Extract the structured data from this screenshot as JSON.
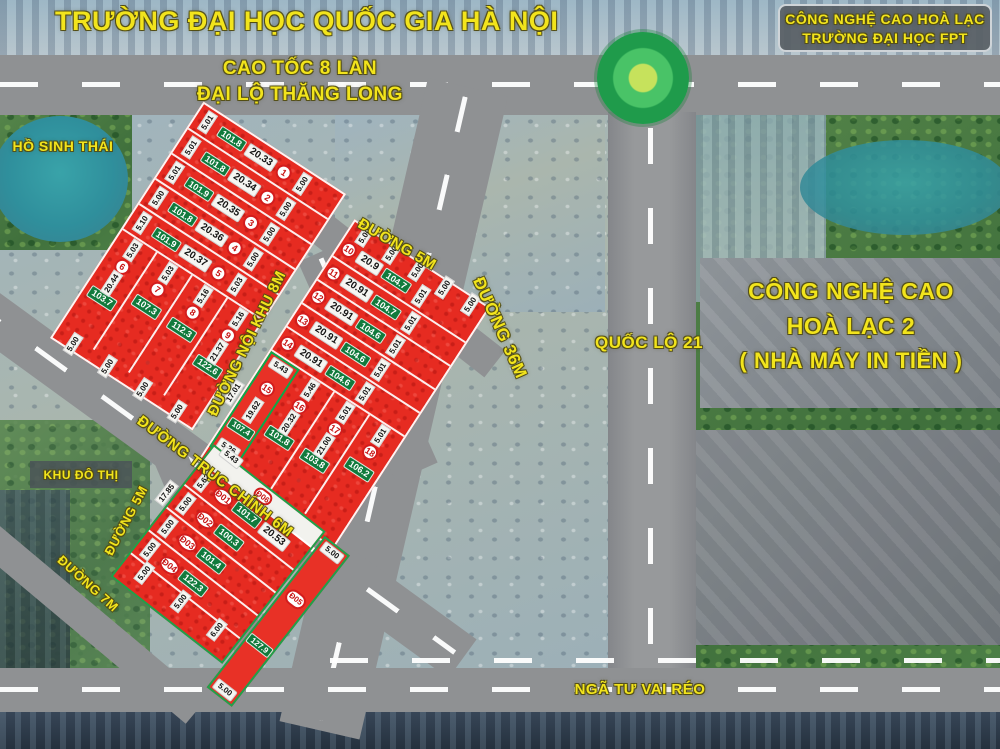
{
  "title": {
    "top": "TRƯỜNG ĐẠI HỌC QUỐC GIA HÀ NỘI"
  },
  "roads": {
    "expressway_1": "CAO TỐC 8 LÀN",
    "expressway_2": "ĐẠI LỘ THĂNG LONG",
    "noi_khu": "ĐƯỜNG NỘI KHU 8M",
    "d5_upper": "ĐƯỜNG 5M",
    "d36": "ĐƯỜNG 36M",
    "ql21": "QUỐC LỘ 21",
    "truc_chinh": "ĐƯỜNG TRỤC CHÍNH 6M",
    "d5_lower": "ĐƯỜNG 5M",
    "d7": "ĐƯỜNG 7M",
    "intersection": "NGÃ TƯ VAI RÉO"
  },
  "areas": {
    "lake": "HỒ SINH THÁI",
    "urban": "KHU ĐÔ THỊ",
    "fpt_1": "CÔNG NGHỆ CAO HOÀ LẠC",
    "fpt_2": "TRƯỜNG ĐẠI HỌC FPT",
    "hitech_1": "CÔNG NGHỆ CAO",
    "hitech_2": "HOÀ LẠC 2",
    "hitech_3": "( NHÀ MÁY IN TIỀN )"
  },
  "colors": {
    "plot_red": "#e62b21",
    "area_green": "#117a3c",
    "label_yellow": "#f2e41c",
    "road_gray": "#8f9193",
    "highlight_green": "#0ca94a",
    "lake_teal": "#2f9aa0"
  },
  "blocks": {
    "block_a": {
      "rows": [
        {
          "no": "1",
          "area": "101.8",
          "width": "20.33",
          "left": "5.01",
          "right": "5.00"
        },
        {
          "no": "2",
          "area": "101.8",
          "width": "20.34",
          "left": "5.01",
          "right": "5.00"
        },
        {
          "no": "3",
          "area": "101.9",
          "width": "20.35",
          "left": "5.01",
          "right": "5.00"
        },
        {
          "no": "4",
          "area": "101.8",
          "width": "20.36",
          "left": "5.00",
          "right": "5.00"
        },
        {
          "no": "5",
          "area": "101.9",
          "width": "20.37",
          "left": "5.10",
          "right": "5.03"
        }
      ],
      "columns": [
        {
          "no": "6",
          "area": "103.7",
          "top": "5.03",
          "depth": "20.44"
        },
        {
          "no": "7",
          "area": "107.3",
          "top": "5.03"
        },
        {
          "no": "8",
          "area": "112.3",
          "top": "5.16"
        },
        {
          "no": "9",
          "area": "122.6",
          "top": "5.16",
          "depth": "21.37"
        }
      ],
      "bottom_edge": [
        "5.00",
        "5.00",
        "5.00",
        "5.00"
      ]
    },
    "block_b": {
      "top_edge": [
        "5.00",
        "5.00",
        "5.00",
        "5.00",
        "5.00"
      ],
      "rows": [
        {
          "no": "10",
          "width": "20.9",
          "area": "104.7",
          "right": "5.01"
        },
        {
          "no": "11",
          "width": "20.91",
          "area": "104.7",
          "right": "5.01"
        },
        {
          "no": "12",
          "width": "20.91",
          "area": "104.6",
          "right": "5.01"
        },
        {
          "no": "13",
          "width": "20.91",
          "area": "104.6",
          "right": "5.01"
        },
        {
          "no": "14",
          "width": "20.91",
          "area": "104.6",
          "right": "5.01"
        }
      ],
      "highlight": {
        "no": "15",
        "area": "107.4",
        "top": "5.43",
        "left": "17.01",
        "right": "19.62",
        "bottom": "5.26"
      },
      "columns": [
        {
          "no": "16",
          "area": "101.8",
          "top": "5.46",
          "depth": "20.32"
        },
        {
          "no": "17",
          "area": "103.8",
          "top": "5.01",
          "depth": "21.00"
        },
        {
          "no": "18",
          "area": "106.2",
          "top": "5.01"
        }
      ]
    },
    "block_c": {
      "road_strip_no": "Đ06",
      "top_edge": "5.43",
      "left_edge": "17.85",
      "rows": [
        {
          "no": "Đ01",
          "area": "101.7",
          "width": "20.53",
          "left": "5.62"
        },
        {
          "no": "Đ02",
          "area": "100.3",
          "left": "5.00"
        },
        {
          "no": "Đ03",
          "area": "101.4",
          "left": "5.00"
        },
        {
          "no": "Đ04",
          "area": "122.3",
          "left": "5.00"
        }
      ],
      "strip": {
        "no": "Đ05",
        "area": "127.9",
        "top": "5.00",
        "bottom": "5.00"
      },
      "bottom_edge": [
        "5.00",
        "5.00",
        "6.00"
      ]
    }
  }
}
